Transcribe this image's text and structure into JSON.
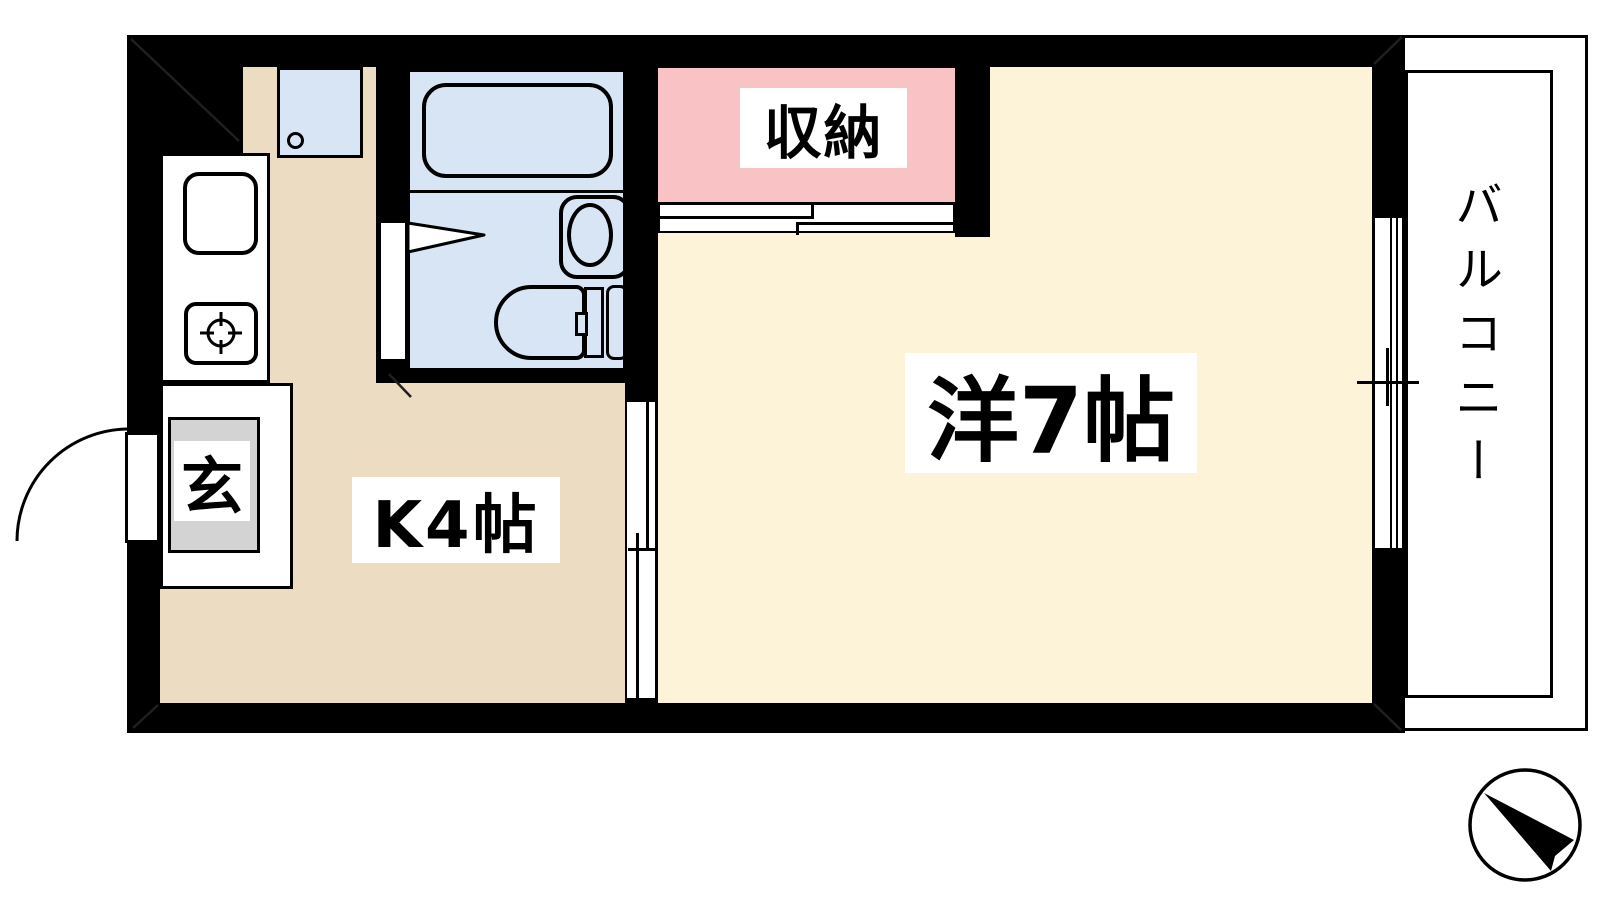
{
  "title": "1K apartment floor plan",
  "labels": {
    "closet": "収納",
    "western_room": "洋7帖",
    "kitchen": "K4帖",
    "entrance": "玄",
    "balcony": "バルコニー"
  },
  "rooms": [
    {
      "name": "western-room",
      "label": "洋7帖",
      "size_jo": 7,
      "floor_color": "#FCF3D8"
    },
    {
      "name": "kitchen",
      "label": "K4帖",
      "size_jo": 4,
      "floor_color": "#EBDCC2"
    },
    {
      "name": "closet",
      "label": "収納",
      "floor_color": "#F9C2C4"
    },
    {
      "name": "bathroom",
      "floor_color": "#D7E5F4",
      "fixtures": [
        "bathtub",
        "washbasin",
        "toilet"
      ]
    },
    {
      "name": "entrance",
      "label": "玄",
      "floor_color": "#D3D3D3"
    },
    {
      "name": "balcony",
      "label": "バルコニー",
      "floor_color": "#FFFFFF"
    }
  ],
  "fixtures": [
    "kitchen-sink",
    "gas-stove",
    "washing-machine-pan",
    "bathtub",
    "washbasin",
    "toilet",
    "closet-sliding-door",
    "room-sliding-door",
    "sliding-window",
    "entrance-swing-door",
    "bathroom-door"
  ],
  "compass": {
    "type": "north-arrow",
    "points": "upper-left"
  },
  "colors": {
    "wall": "#000000",
    "kitchen_floor": "#EBDCC2",
    "room_floor": "#FCF3D8",
    "closet_floor": "#F9C2C4",
    "bath_floor": "#D7E5F4",
    "entrance_tile": "#D3D3D3",
    "label_bg": "#FFFFFF",
    "line": "#000000"
  }
}
